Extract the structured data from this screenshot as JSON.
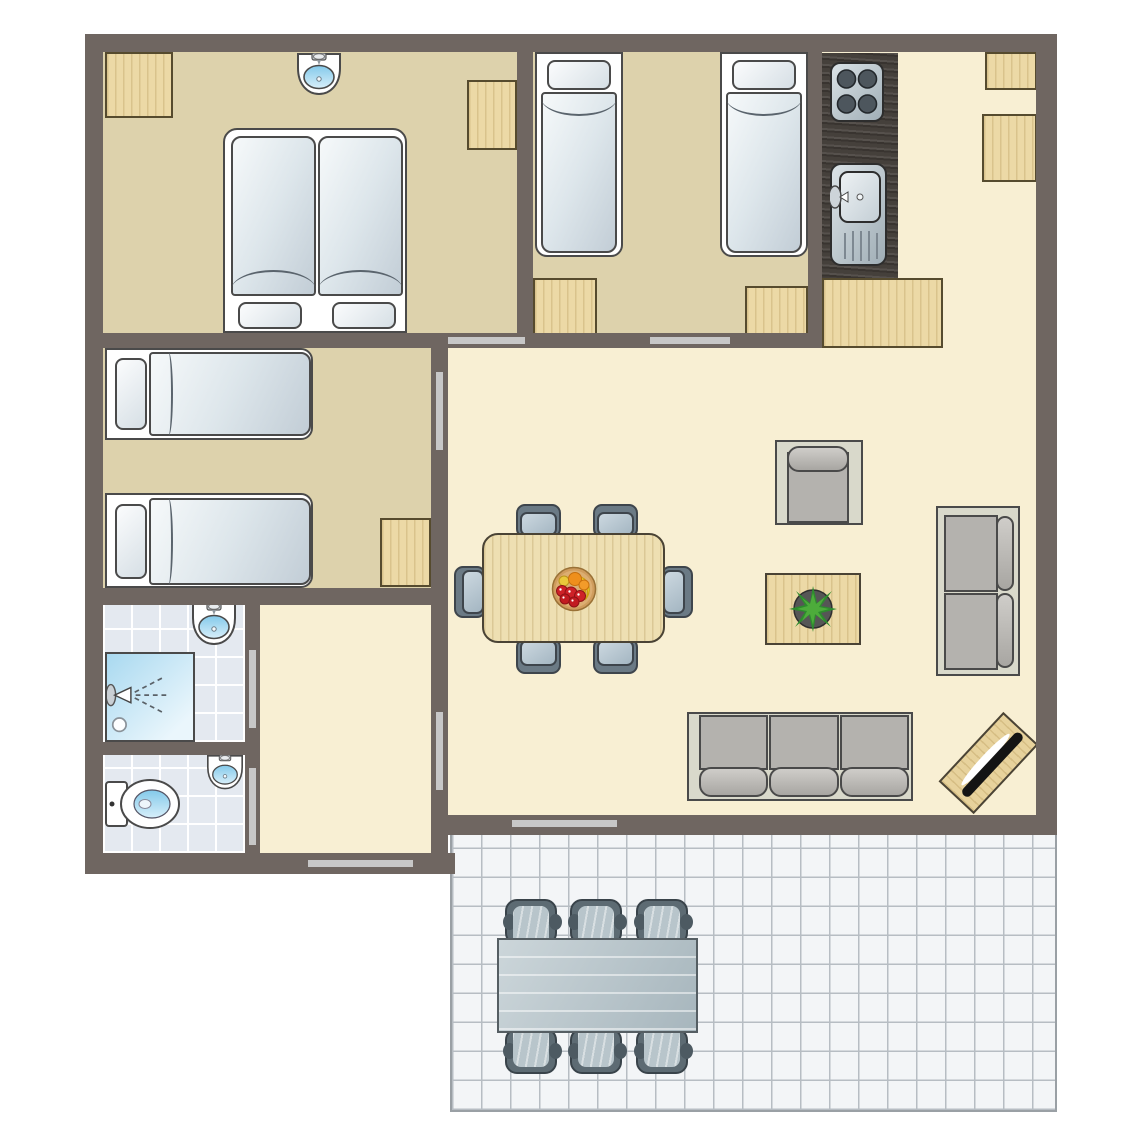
{
  "title": "Holiday home floor plan",
  "palette": {
    "wall": "#6f6661",
    "door_marker": "#c7c7c7",
    "floor_bedroom": "#ddd2ac",
    "floor_living": "#f8efd3",
    "floor_tile": "#e4e9f0",
    "tile_grout": "#ffffff",
    "terrace_floor": "#f3f5f7",
    "terrace_grout": "#b7bdc3",
    "wood": "#ecd9a6",
    "wood_border": "#564b2e",
    "counter_dark": "#45403b",
    "outline": "#4a4a4a",
    "mattress_hi": "#f6f9fa",
    "mattress_lo": "#c2cdd6",
    "sofa_base": "#d9d9cb",
    "cushion": "#b4b2ae",
    "chair_dark": "#6b7a85",
    "chair_border": "#3e454c",
    "terrace_chair": "#5d6b73",
    "terrace_chair_seat": "#b8c5cb",
    "terrace_table_hi": "#ccd6da",
    "terrace_table_lo": "#a7b6bd",
    "basin_blue": "#83c9ea",
    "shower_blue": "#a9d9f0",
    "plant_green": "#2e8b2e",
    "fruit_red": "#ce2127",
    "fruit_orange": "#ef8f1c",
    "fruit_yellow": "#f2d435",
    "tv_black": "#141414"
  },
  "rooms": [
    {
      "id": "bedroom-1",
      "name": "Double bedroom",
      "furniture": [
        "double bed",
        "washbasin",
        "cabinet",
        "cabinet"
      ]
    },
    {
      "id": "bedroom-2",
      "name": "Twin bedroom",
      "furniture": [
        "single bed",
        "single bed",
        "nightstand",
        "nightstand"
      ]
    },
    {
      "id": "kitchen",
      "name": "Kitchen",
      "furniture": [
        "hob",
        "sink unit",
        "counter",
        "cabinet",
        "cabinet",
        "cabinet"
      ]
    },
    {
      "id": "living-room",
      "name": "Living / dining room",
      "furniture": [
        "dining table",
        "6 dining chairs",
        "fruit bowl",
        "armchair",
        "coffee table",
        "plant",
        "2-seat sofa",
        "3-seat sofa",
        "TV stand"
      ]
    },
    {
      "id": "bedroom-3",
      "name": "Twin bedroom",
      "furniture": [
        "single bed",
        "single bed",
        "nightstand"
      ]
    },
    {
      "id": "hallway",
      "name": "Hallway",
      "furniture": []
    },
    {
      "id": "bathroom",
      "name": "Bathroom",
      "furniture": [
        "washbasin",
        "shower"
      ]
    },
    {
      "id": "toilet",
      "name": "Toilet",
      "furniture": [
        "toilet",
        "washbasin"
      ]
    },
    {
      "id": "terrace",
      "name": "Terrace",
      "furniture": [
        "garden table",
        "6 garden chairs"
      ]
    }
  ],
  "doors": [
    "Door to double bedroom",
    "Door to twin bedroom",
    "Door to twin bedroom 2",
    "Door between hallway and living room",
    "Bathroom door",
    "Toilet door",
    "Entrance door",
    "Terrace door"
  ],
  "labels": {
    "double_bed": "Double bed",
    "single_bed": "Single bed",
    "washbasin": "Washbasin",
    "shower": "Shower",
    "toilet": "Toilet",
    "hob": "Hob",
    "kitchen_sink": "Kitchen sink",
    "dining_table": "Dining table",
    "dining_chair": "Dining chair",
    "fruit_bowl": "Fruit bowl",
    "armchair": "Armchair",
    "coffee_table": "Coffee table with plant",
    "sofa_2": "Two-seat sofa",
    "sofa_3": "Three-seat sofa",
    "tv_stand": "TV stand",
    "garden_table": "Garden table",
    "garden_chair": "Garden chair",
    "cabinet": "Cabinet"
  }
}
